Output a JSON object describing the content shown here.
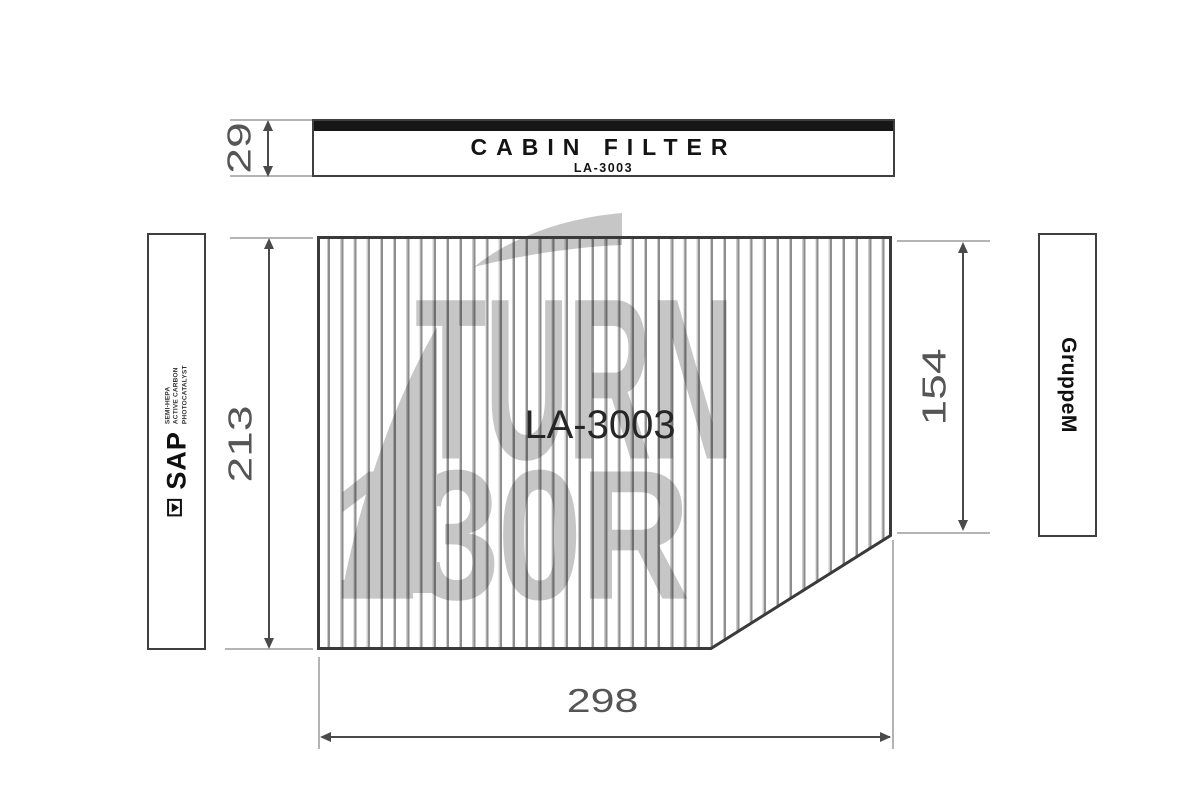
{
  "header": {
    "title": "CABIN FILTER",
    "part_number": "LA-3003"
  },
  "filter": {
    "code": "LA-3003"
  },
  "dimensions": {
    "package_height": "29",
    "filter_height": "213",
    "right_edge_height": "154",
    "filter_width": "298"
  },
  "left_label": {
    "brand": "SAP",
    "features": [
      "SEMI-HEPA",
      "ACTIVE CARBON",
      "PHOTOCATALYST"
    ]
  },
  "right_label": {
    "brand": "GruppeM"
  },
  "watermark": {
    "line1": "TURN",
    "line2": "130R"
  },
  "colors": {
    "line": "#3a3a3a",
    "extension_line": "#b4b4b4",
    "watermark_gray": "#c6c6c6",
    "header_bar": "#161616"
  }
}
